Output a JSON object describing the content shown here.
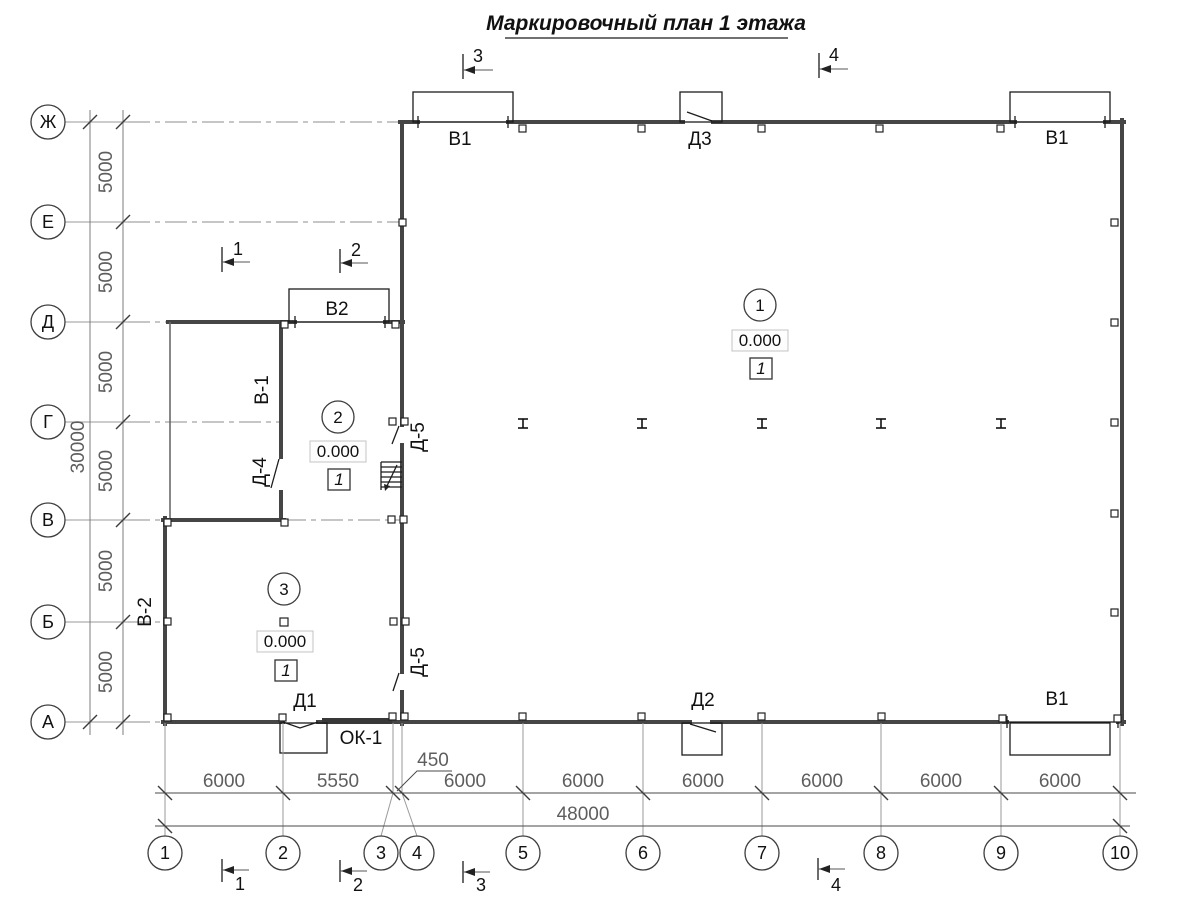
{
  "title": "Маркировочный план 1 этажа",
  "plan": {
    "row_axes": [
      "Ж",
      "Е",
      "Д",
      "Г",
      "В",
      "Б",
      "А"
    ],
    "col_axes": [
      "1",
      "2",
      "3",
      "4",
      "5",
      "6",
      "7",
      "8",
      "9",
      "10"
    ],
    "dims": {
      "row_spacing": [
        "5000",
        "5000",
        "5000",
        "5000",
        "5000",
        "5000"
      ],
      "row_total": "30000",
      "col_spacing": [
        "6000",
        "5550",
        "450",
        "6000",
        "6000",
        "6000",
        "6000",
        "6000",
        "6000"
      ],
      "col_total": "48000"
    },
    "rooms": [
      {
        "number": "1",
        "elevation": "0.000",
        "finish": "1"
      },
      {
        "number": "2",
        "elevation": "0.000",
        "finish": "1"
      },
      {
        "number": "3",
        "elevation": "0.000",
        "finish": "1"
      }
    ],
    "openings": {
      "gate_top_left": "В1",
      "door_top": "Д3",
      "gate_top_right": "В1",
      "gate_annex": "В2",
      "wall_inner": "В-1",
      "wall_left": "В-2",
      "door_inner": "Д-4",
      "door_hall_upper": "Д-5",
      "door_hall_lower": "Д-5",
      "door_bottom_left": "Д1",
      "window_bottom": "ОК-1",
      "door_bottom_mid": "Д2",
      "gate_bottom_right": "В1"
    },
    "sections": {
      "top": [
        "3",
        "4"
      ],
      "middle": [
        "1",
        "2"
      ],
      "bottom": [
        "1",
        "2",
        "3",
        "4"
      ]
    },
    "colors": {
      "line": "#454545",
      "grid": "#9a9a9a",
      "dim_text": "#5e5e5e"
    }
  }
}
